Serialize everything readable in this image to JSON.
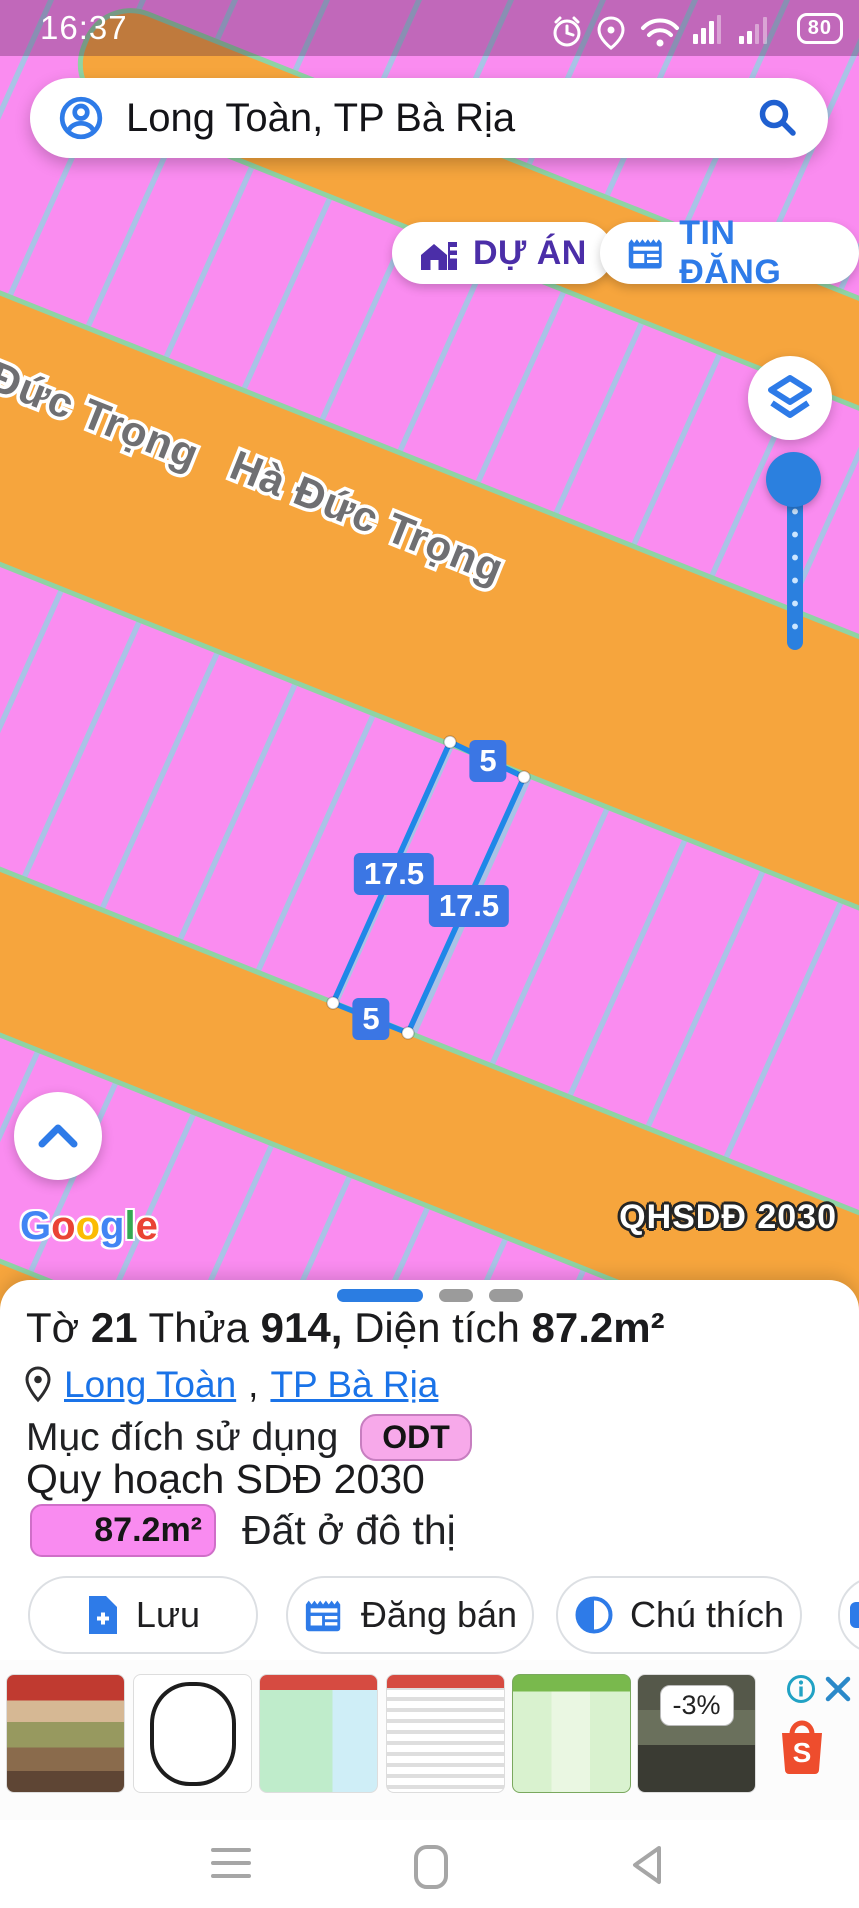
{
  "status_bar": {
    "time": "16:37",
    "battery_percent": "80"
  },
  "search_bar": {
    "query": "Long Toàn, TP Bà Rịa"
  },
  "overlay_buttons": {
    "project": "DỰ ÁN",
    "listing": "TIN ĐĂNG"
  },
  "map": {
    "street_left": "Đức Trọng",
    "street_main": "Hà Đức Trọng",
    "plan_badge": "QHSDĐ 2030",
    "google_logo": [
      "G",
      "o",
      "o",
      "g",
      "l",
      "e"
    ],
    "parcel_dims": {
      "top": "5",
      "left": "17.5",
      "right": "17.5",
      "bottom": "5"
    },
    "colors": {
      "parcel_fill": "#fa8cf0",
      "road_fill": "#f6a53d",
      "road_edge": "#8fd3a4",
      "lot_line": "#a9c3e6",
      "highlight_line": "#1f87e8"
    }
  },
  "sheet": {
    "title": {
      "t1": "Tờ ",
      "v1": "21",
      "t2": " Thửa ",
      "v2": "914,",
      "t3": " Diện tích ",
      "v3": "87.2m²"
    },
    "location": {
      "ward": "Long Toàn",
      "separator": ",",
      "city": "TP Bà Rịa"
    },
    "purpose_label": "Mục đích sử dụng",
    "purpose_code": "ODT",
    "plan_title": "Quy hoạch SDĐ 2030",
    "area_value": "87.2m²",
    "area_type": "Đất ở đô thị",
    "actions": {
      "save": "Lưu",
      "sell": "Đăng bán",
      "legend": "Chú thích"
    }
  },
  "ad": {
    "discount_badge": "-3%"
  },
  "colors": {
    "accent_blue": "#2e7be8",
    "purple": "#4b2ea8",
    "link_blue": "#1a73e8",
    "shopee_orange": "#ee4d2d"
  }
}
